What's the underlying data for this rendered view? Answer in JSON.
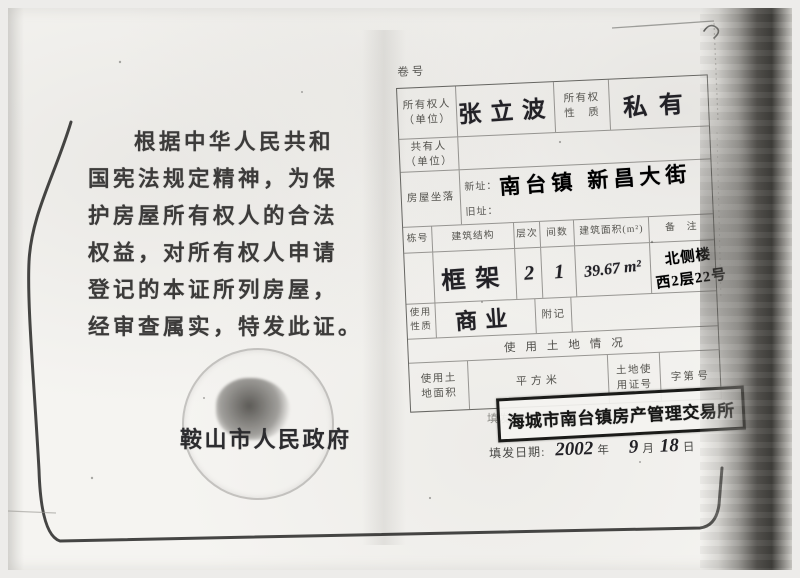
{
  "left_page": {
    "paragraph": [
      "根据中华人民共和",
      "国宪法规定精神，为保",
      "护房屋所有权人的合法",
      "权益，对所有权人申请",
      "登记的本证所列房屋，",
      "经审查属实，特发此证。"
    ],
    "seal_text": "鞍山市人民政府"
  },
  "right_page": {
    "volume_label": "卷号",
    "owner_label": "所有权人\n（单位）",
    "owner_value": "张立波",
    "ownership_nature_label": "所有权\n性　质",
    "ownership_nature_value": "私有",
    "co_owner_label": "共有人\n（单位）",
    "location_label": "房屋坐落",
    "location_new_label": "新址：",
    "location_new_value": "南台镇 新昌大街",
    "location_old_label": "旧址：",
    "building_headers": [
      "栋号",
      "建筑结构",
      "层次",
      "间数",
      "建筑面积(m²)",
      "备　注"
    ],
    "building_structure_value": "框架",
    "floors_value": "2",
    "rooms_value": "1",
    "area_value": "39.67 m²",
    "remark_line1": "北侧楼",
    "remark_line2": "西2层22号",
    "usage_label": "使用\n性质",
    "usage_value": "商业",
    "annotation_label": "附记",
    "land_section_title": "使用土地情况",
    "land_area_label": "使用土\n地面积",
    "land_unit_label": "平方米",
    "land_cert_label": "土地使\n用证号",
    "land_cert_prefix": "字第",
    "land_cert_suffix": "号",
    "issuing_office_label": "填发机关:",
    "stamp_text": "海城市南台镇房产管理交易所",
    "issue_date_label": "填发日期:",
    "issue_year": "2002",
    "year_unit": "年",
    "issue_month": "9",
    "month_unit": "月",
    "issue_day": "18",
    "day_unit": "日"
  }
}
